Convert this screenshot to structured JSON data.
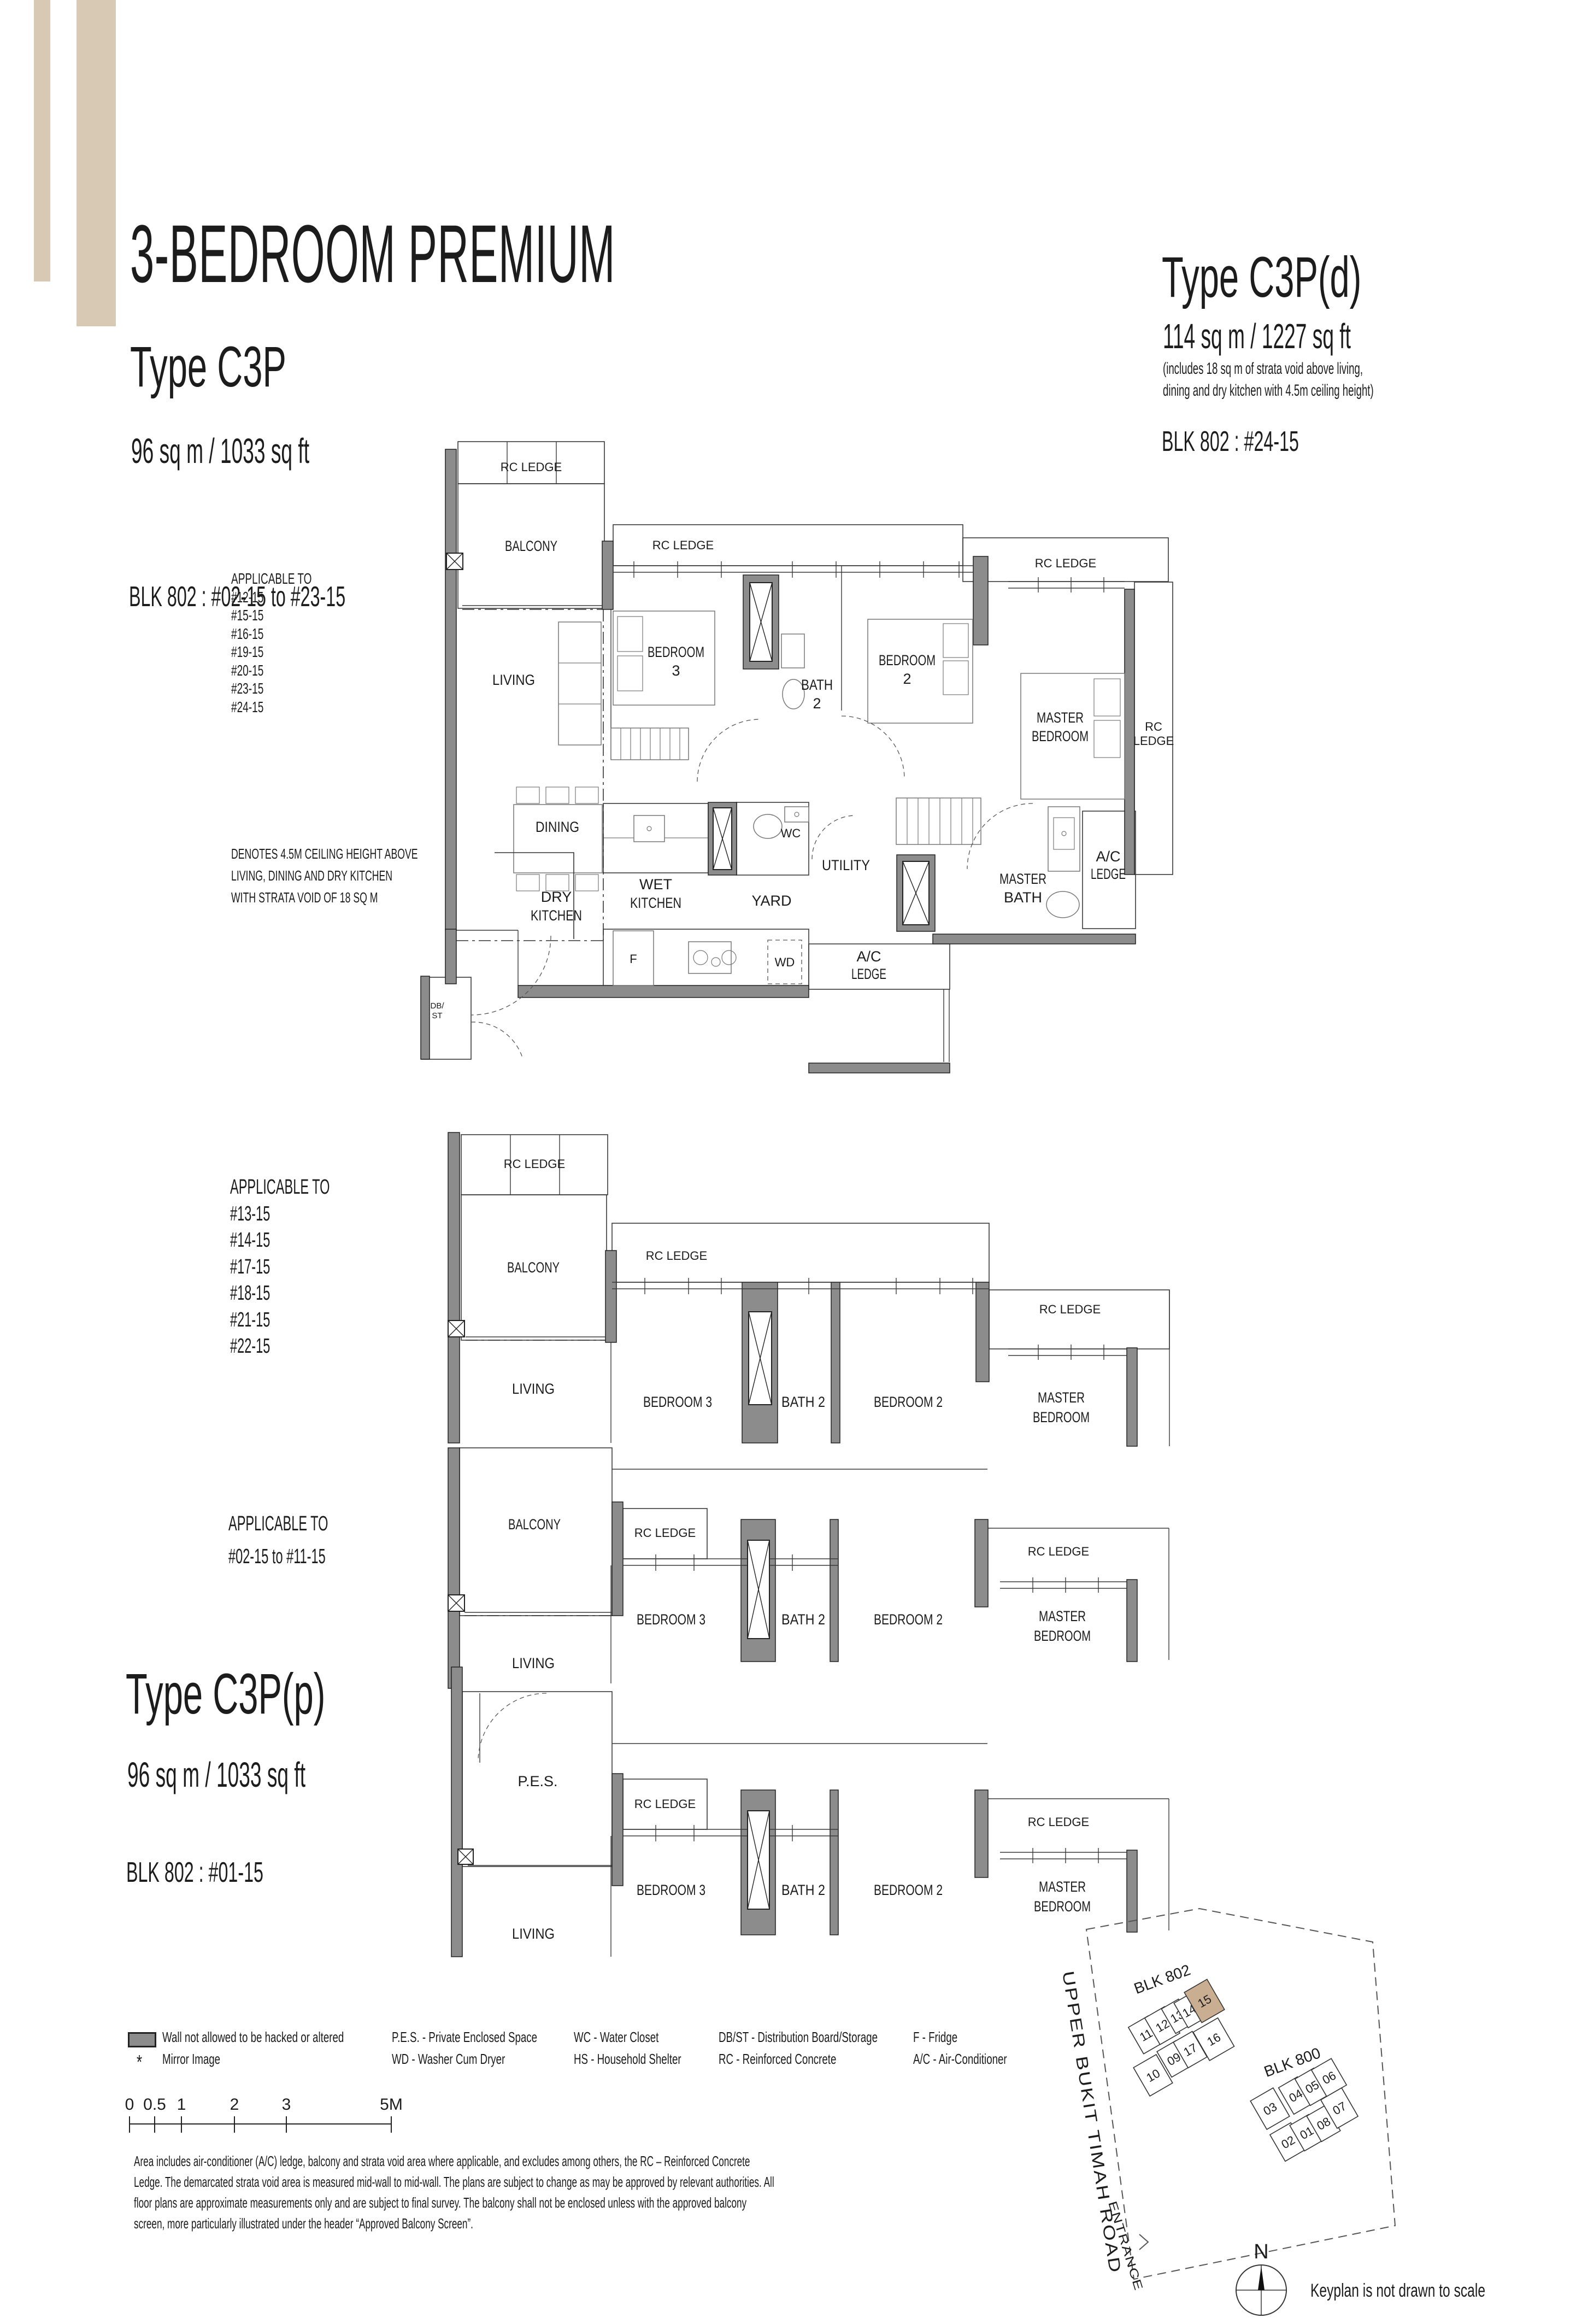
{
  "colors": {
    "accent_bar": "#d8c9b4",
    "wall": "#8c8c8c",
    "highlight": "#c9ae92"
  },
  "header": {
    "title": "3-BEDROOM PREMIUM"
  },
  "types": {
    "c3p": {
      "name": "Type C3P",
      "area": "96 sq m / 1033 sq ft",
      "blk": "BLK 802 : #02-15 to #23-15"
    },
    "c3pd": {
      "name": "Type C3P(d)",
      "area": "114 sq m / 1227 sq ft",
      "note1": "(includes 18 sq m of strata void above living,",
      "note2": "dining and dry kitchen with 4.5m ceiling height)",
      "blk": "BLK 802 : #24-15"
    },
    "c3pp": {
      "name": "Type C3P(p)",
      "area": "96 sq m / 1033 sq ft",
      "blk": "BLK 802 : #01-15"
    }
  },
  "applicable1": {
    "heading": "APPLICABLE TO",
    "units": [
      "#12-15",
      "#15-15",
      "#16-15",
      "#19-15",
      "#20-15",
      "#23-15",
      "#24-15"
    ]
  },
  "applicable2": {
    "heading": "APPLICABLE TO",
    "units": [
      "#13-15",
      "#14-15",
      "#17-15",
      "#18-15",
      "#21-15",
      "#22-15"
    ]
  },
  "applicable3": {
    "heading": "APPLICABLE TO",
    "range": "#02-15 to #11-15"
  },
  "strata_note": {
    "line1": "DENOTES 4.5M CEILING HEIGHT ABOVE",
    "line2": "LIVING, DINING AND DRY KITCHEN",
    "line3": "WITH STRATA VOID OF 18 SQ M"
  },
  "rooms": {
    "rc_ledge": "RC LEDGE",
    "balcony": "BALCONY",
    "living": "LIVING",
    "bedroom": "BEDROOM",
    "three": "3",
    "two": "2",
    "bath": "BATH",
    "bedroom3": "BEDROOM 3",
    "bath2": "BATH 2",
    "bedroom2": "BEDROOM 2",
    "master": "MASTER",
    "dining": "DINING",
    "dry": "DRY",
    "wet": "WET",
    "kitchen": "KITCHEN",
    "yard": "YARD",
    "utility": "UTILITY",
    "wc": "WC",
    "f": "F",
    "wd": "WD",
    "rc": "RC",
    "ledge": "LEDGE",
    "ac": "A/C",
    "db1": "DB/",
    "db2": "ST",
    "pes": "P.E.S."
  },
  "legend": {
    "wall": "Wall not allowed to be hacked or altered",
    "mirror_symbol": "*",
    "mirror": "Mirror Image",
    "pes": "P.E.S. - Private Enclosed Space",
    "wd": "WD - Washer Cum Dryer",
    "wc": "WC - Water Closet",
    "hs": "HS - Household Shelter",
    "dbst": "DB/ST - Distribution Board/Storage",
    "rc": "RC - Reinforced Concrete",
    "f": "F - Fridge",
    "ac": "A/C - Air-Conditioner"
  },
  "scalebar": {
    "t0": "0",
    "t05": "0.5",
    "t1": "1",
    "t2": "2",
    "t3": "3",
    "t5": "5M"
  },
  "disclaimer": {
    "line1": "Area includes air-conditioner (A/C) ledge, balcony and strata void area where applicable, and excludes among others, the RC – Reinforced Concrete",
    "line2": "Ledge. The demarcated strata void area is measured mid-wall to mid-wall. The plans are subject to change as may be approved by relevant authorities. All",
    "line3": "floor plans are approximate measurements only and are subject to final survey. The balcony shall not be enclosed unless with the approved balcony",
    "line4": "screen, more particularly illustrated under the header “Approved Balcony Screen”."
  },
  "keyplan": {
    "blk802": "BLK 802",
    "blk800": "BLK 800",
    "u10": "10",
    "u11": "11",
    "u12": "12",
    "u13": "13",
    "u14": "14",
    "u15": "15",
    "u16": "16",
    "u17": "17",
    "u09": "09",
    "u01": "01",
    "u02": "02",
    "u03": "03",
    "u04": "04",
    "u05": "05",
    "u06": "06",
    "u07": "07",
    "u08": "08",
    "road": "UPPER BUKIT TIMAH ROAD",
    "entrance": "ENTRANCE",
    "north": "N",
    "note": "Keyplan is not drawn to scale"
  }
}
